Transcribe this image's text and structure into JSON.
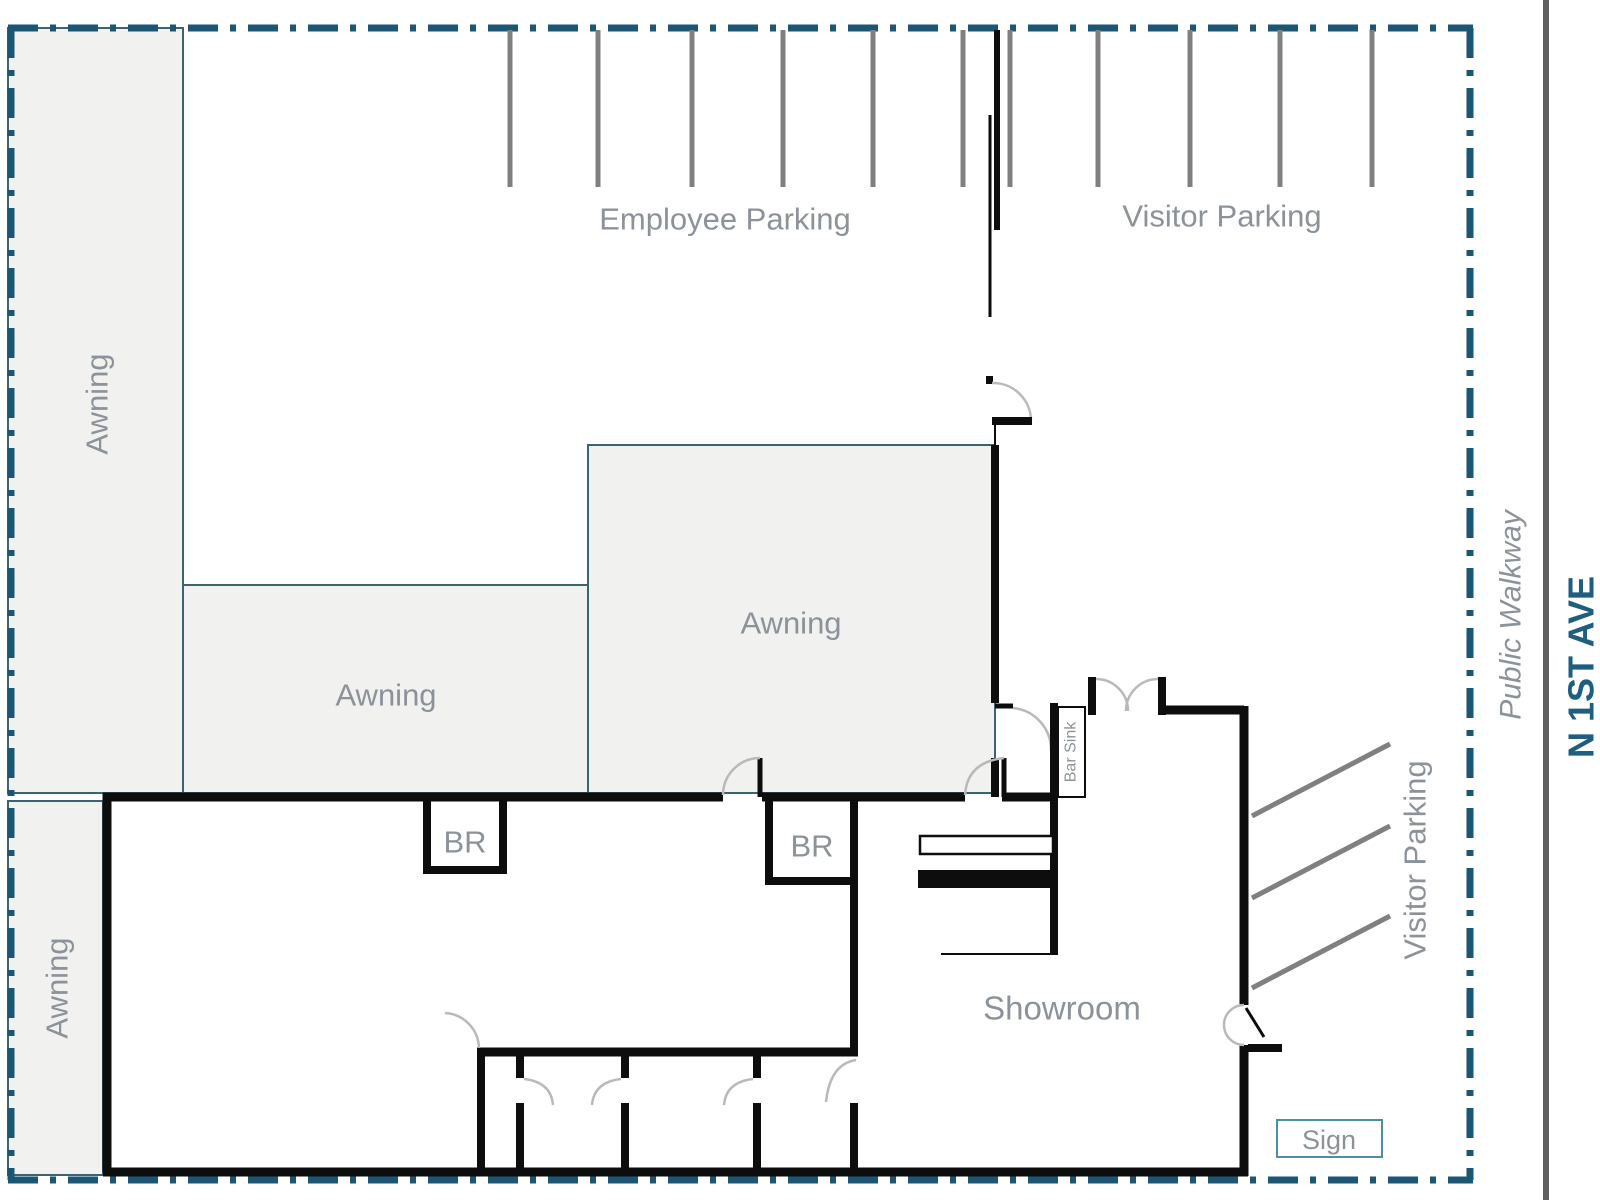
{
  "plan": {
    "labels": {
      "employee_parking": "Employee Parking",
      "visitor_parking_top": "Visitor Parking",
      "visitor_parking_side": "Visitor Parking",
      "awning_left": "Awning",
      "awning_middle": "Awning",
      "awning_center": "Awning",
      "awning_lower_left": "Awning",
      "bathroom_1": "BR",
      "bathroom_2": "BR",
      "bar_sink": "Bar Sink",
      "showroom": "Showroom",
      "sign": "Sign",
      "public_walkway": "Public Walkway",
      "street_name": "N 1ST AVE"
    },
    "colors": {
      "boundary": "#1b5674",
      "street_text": "#1e5f80",
      "street_line": "#5f5f5f",
      "label_gray": "#8c929a",
      "wall": "#0d0d0d",
      "stall_gray": "#808080",
      "awning_fill": "#f1f1ef",
      "awning_border": "#3c6470",
      "sign_border": "#4b8fa0",
      "door_arc": "#b9b9b9"
    }
  }
}
